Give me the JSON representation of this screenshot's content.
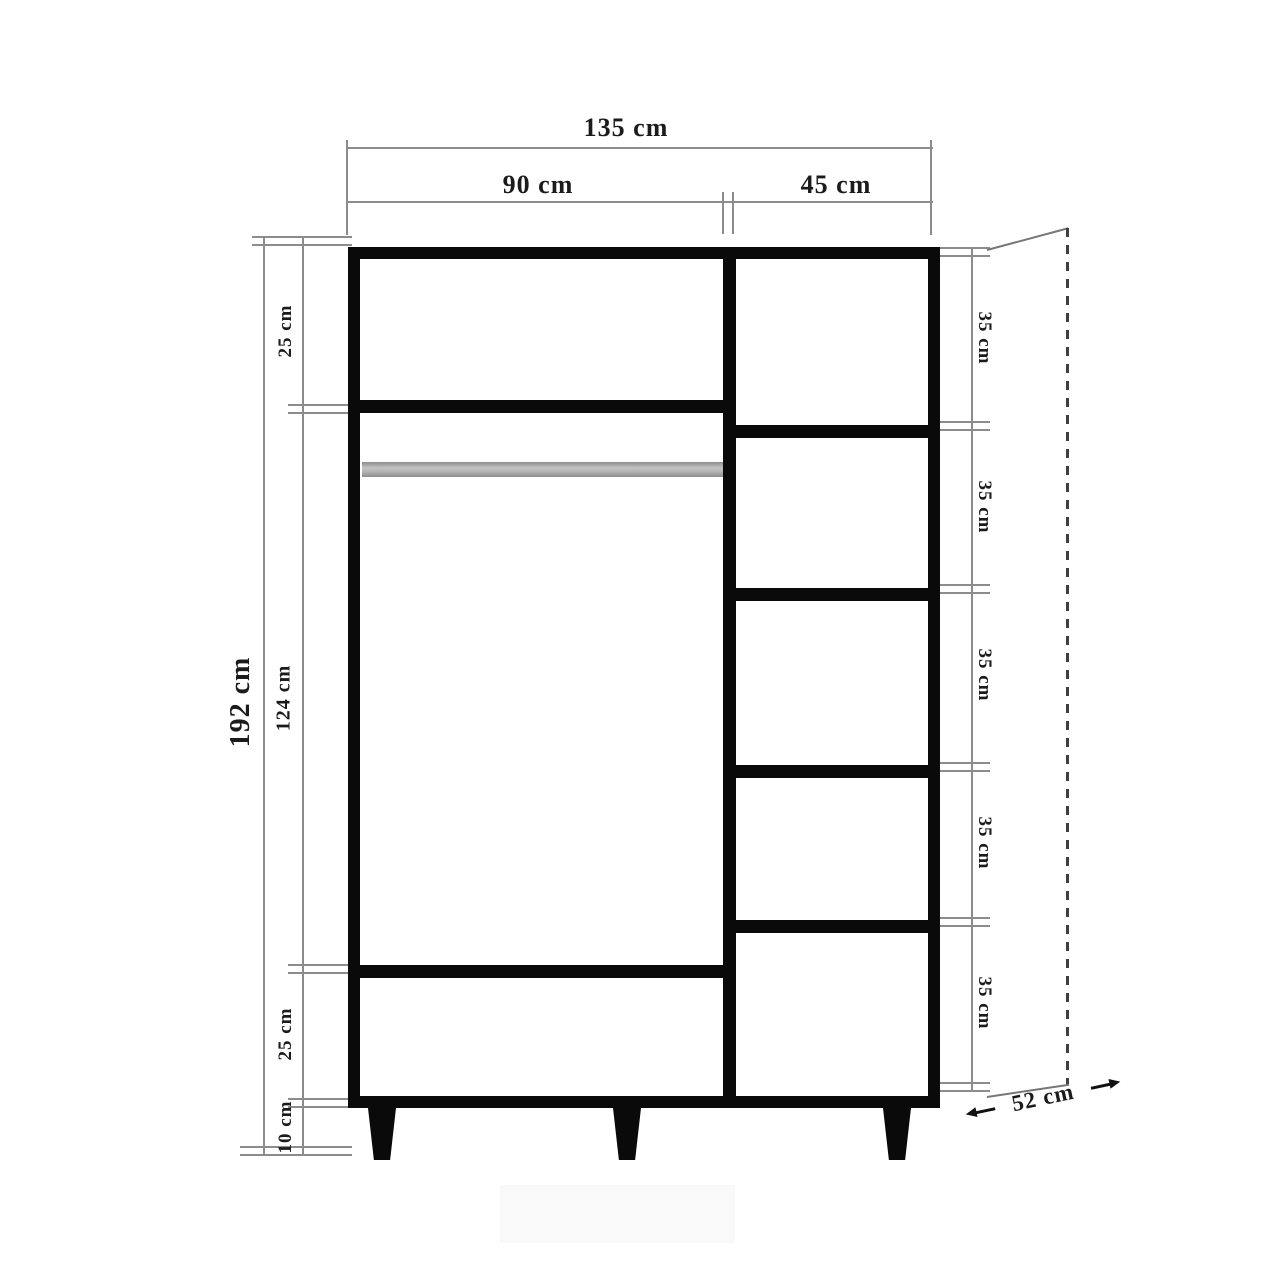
{
  "dimensions": {
    "width_total": "135 cm",
    "width_left": "90 cm",
    "width_right": "45 cm",
    "height_total": "192 cm",
    "left_heights": [
      "25 cm",
      "124 cm",
      "25 cm",
      "10 cm"
    ],
    "right_heights": [
      "35 cm",
      "35 cm",
      "35 cm",
      "35 cm",
      "35 cm"
    ],
    "depth": "52 cm"
  },
  "colors": {
    "background": "#ffffff",
    "body_outline": "#0a0a0a",
    "dimension_line": "#8c8c8c",
    "text": "#1b1b1b",
    "hanging_rod": "#c2c2c2"
  }
}
